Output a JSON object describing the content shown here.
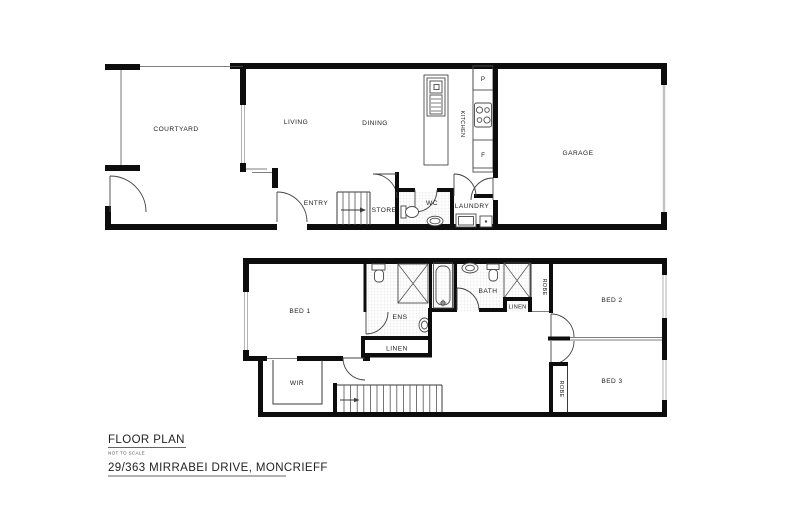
{
  "document": {
    "type": "real-estate floor plan",
    "background": "#ffffff"
  },
  "ground_floor": {
    "courtyard": "COURTYARD",
    "living": "LIVING",
    "dining": "DINING",
    "kitchen": "KITCHEN",
    "pantry_label": "P",
    "fridge_label": "F",
    "garage": "GARAGE",
    "entry": "ENTRY",
    "store": "STORE",
    "wc": "WC",
    "laundry": "LAUNDRY"
  },
  "upper_floor": {
    "bed1": "BED 1",
    "wir": "WIR",
    "ens": "ENS",
    "linen_hall": "LINEN",
    "bath": "BATH",
    "linen_bath": "LINEN",
    "robe_bed2": "ROBE",
    "bed2": "BED 2",
    "bed3": "BED 3",
    "robe_bed3": "ROBE"
  },
  "footer": {
    "title": "FLOOR PLAN",
    "scale_note": "NOT TO SCALE",
    "address": "29/363 MIRRABEI DRIVE, MONCRIEFF"
  },
  "colors": {
    "wall": "#0d0d0d",
    "tile": "#d9d9d9",
    "window": "#b3b3b3",
    "garage_door": "#c4c4c4"
  }
}
